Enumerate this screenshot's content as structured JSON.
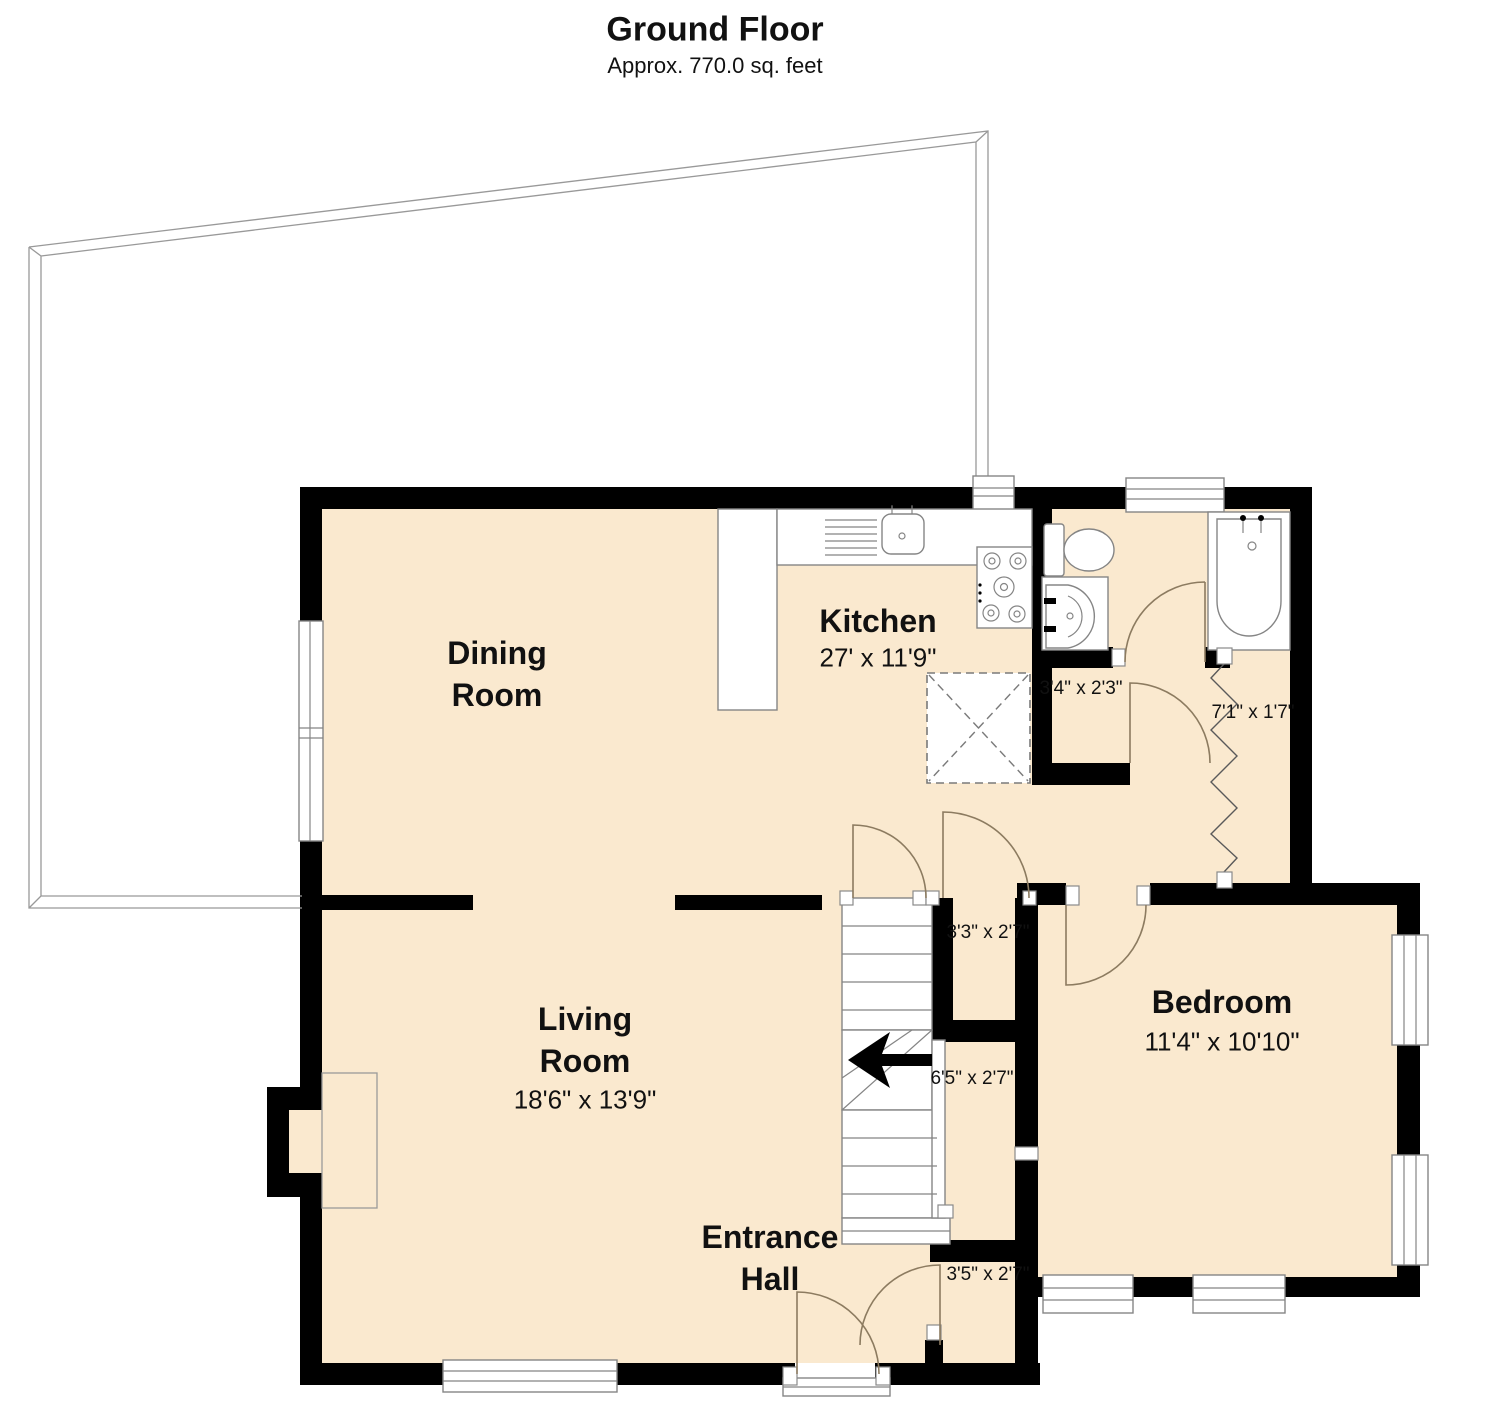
{
  "title": "Ground Floor",
  "subtitle": "Approx. 770.0 sq. feet",
  "rooms": {
    "dining": {
      "line1": "Dining",
      "line2": "Room"
    },
    "kitchen": {
      "name": "Kitchen",
      "dims": "27' x 11'9\""
    },
    "living": {
      "line1": "Living",
      "line2": "Room",
      "dims": "18'6\" x 13'9\""
    },
    "entrance": {
      "line1": "Entrance",
      "line2": "Hall"
    },
    "bedroom": {
      "name": "Bedroom",
      "dims": "11'4\" x 10'10\""
    }
  },
  "dims": {
    "wc_lobby": "3'4\" x 2'3\"",
    "airing_corridor": "7'1\" x 1'7\"",
    "landing_closet": "3'3\" x 2'7\"",
    "hall_closet": "6'5\" x 2'7\"",
    "entry_closet": "3'5\" x 2'7\""
  },
  "colors": {
    "floor": "#FAE9CF",
    "wall": "#000000",
    "fixture_outline": "#858585",
    "door_swing": "#8C7B60",
    "deck_outline": "#999999"
  }
}
